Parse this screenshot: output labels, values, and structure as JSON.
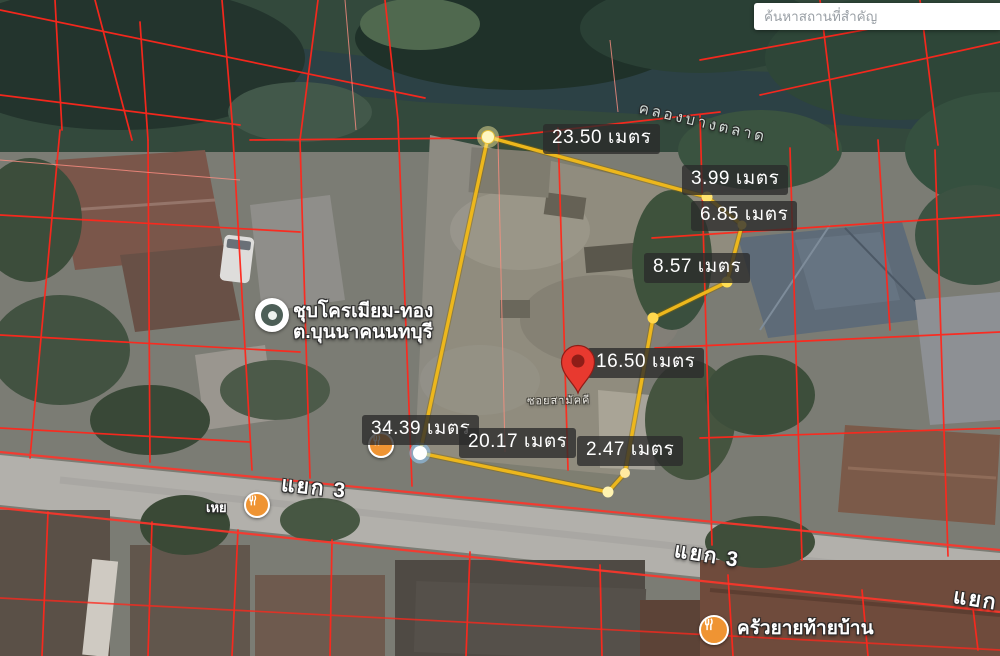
{
  "search": {
    "placeholder": "ค้นหาสถานที่สำคัญ"
  },
  "measurements": [
    "23.50 เมตร",
    "3.99 เมตร",
    "6.85 เมตร",
    "8.57 เมตร",
    "16.50 เมตร",
    "34.39 เมตร",
    "20.17 เมตร",
    "2.47 เมตร"
  ],
  "labels": {
    "canal": "คลองบางตลาด",
    "street_small": "ซอยสามัคคี"
  },
  "road_junctions": [
    "แยก 3",
    "แยก 3",
    "แยก"
  ],
  "places": {
    "plating_shop": {
      "line1": "ชุบโครเมียม-ทอง",
      "line2": "ต.บุนนาคนนทบุรี"
    },
    "restaurant": {
      "name": "ครัวยายท้ายบ้าน"
    },
    "small_shop": {
      "name": "เหย"
    }
  },
  "icons": {
    "pin": "map-pin",
    "plating_shop": "business-circle-icon",
    "restaurant": "restaurant-icon",
    "small_shop": "food-shop-icon",
    "search": "search-input"
  },
  "colors": {
    "plot_outline": "#edb71c",
    "parcel_lines": "#ff271c",
    "pin_red": "#e8392f",
    "label_background": "#2a2a2a",
    "poi_orange": "#ef9433"
  }
}
